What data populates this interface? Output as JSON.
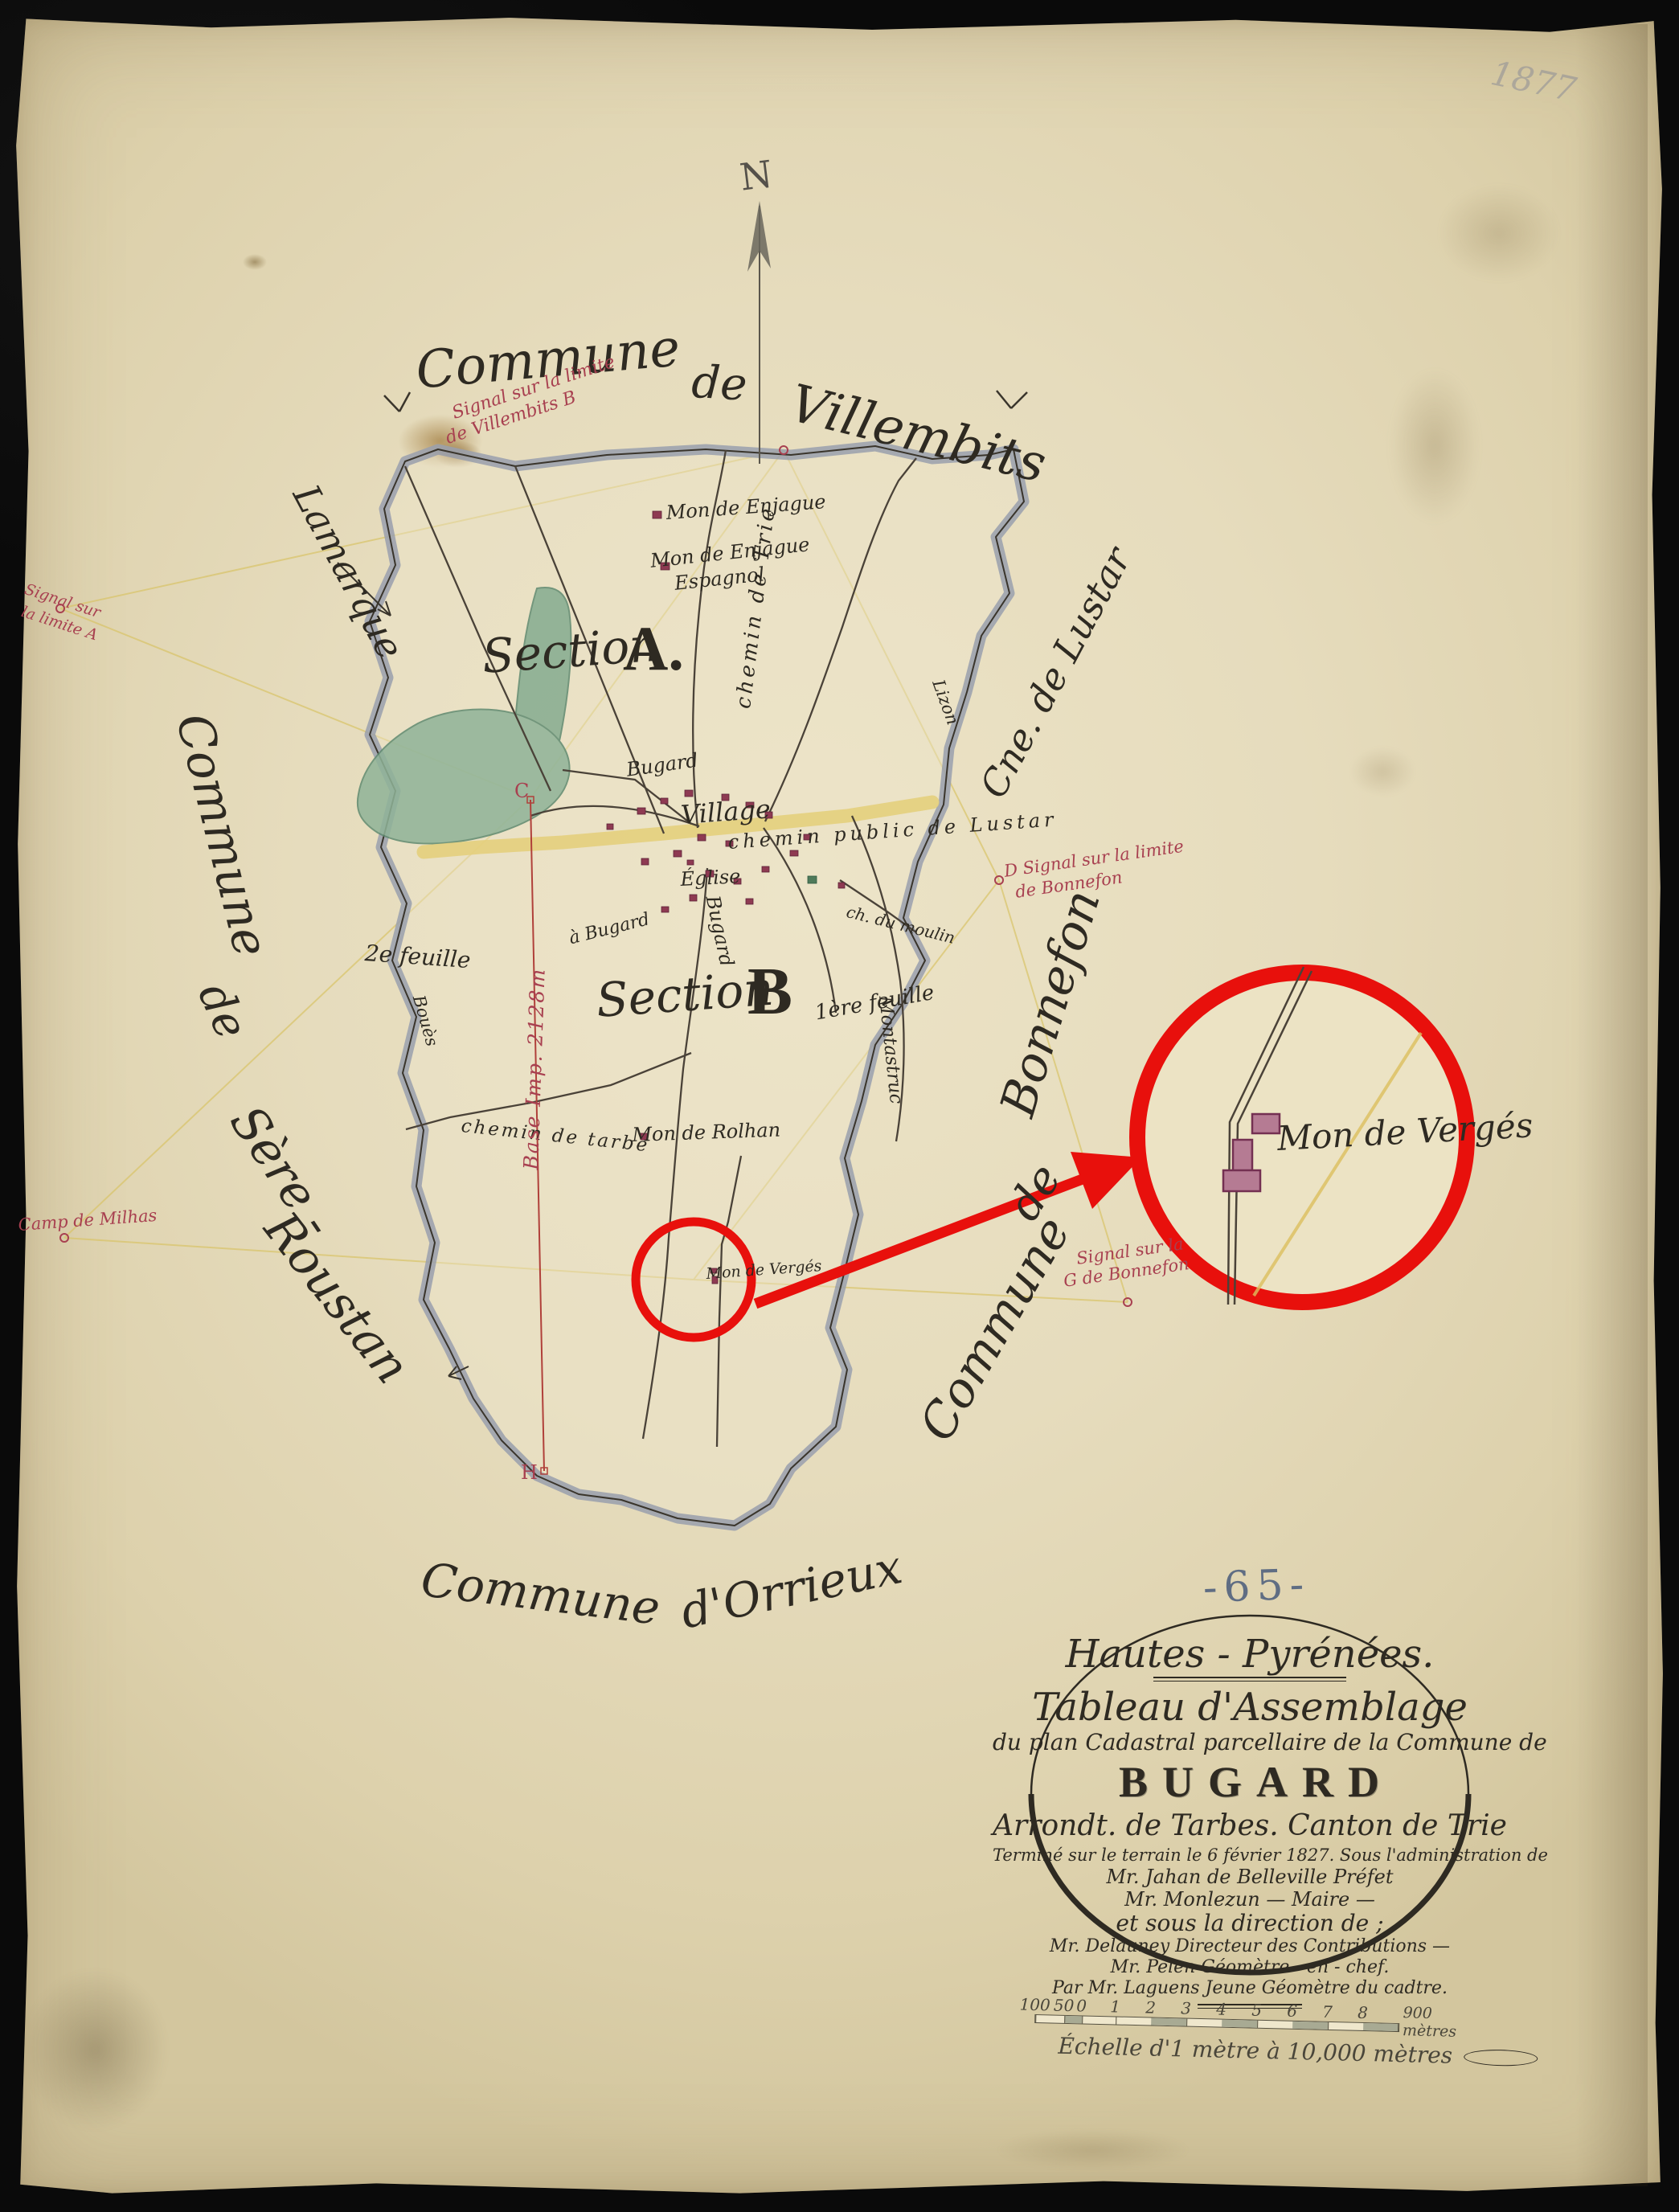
{
  "page": {
    "sheet_number": "-65-",
    "pencil_note": "1877",
    "north_label": "N"
  },
  "neighbors": {
    "top": {
      "w1": "Commune",
      "w2": "de",
      "w3": "Villembits"
    },
    "left_upper": "Lamarque",
    "left": {
      "w1": "Commune",
      "w2": "de",
      "w3": "Sère -",
      "w4": "Roustan"
    },
    "right_upper": "Cne. de Lustar",
    "right_lower": {
      "w1": "Commune",
      "w2": "de",
      "w3": "Bonnefon"
    },
    "bottom": {
      "w1": "Commune",
      "w2": "d'Orrieux"
    }
  },
  "sections": {
    "a_word": "Section",
    "a_letter": "A.",
    "b_word": "Section",
    "b_letter": "B",
    "b_note": "1ère feuille",
    "second_sheet": "2e feuille"
  },
  "village": {
    "name": "Village",
    "church": "Église"
  },
  "roads": {
    "bugard1": "Bugard",
    "bugard2": "Bugard",
    "bugard3": "à Bugard",
    "trie": "chemin de Trie",
    "lustar": "chemin public de Lustar",
    "tarbe": "chemin de tarbe",
    "moulin": "ch. du moulin",
    "montastruc": "Montastruc"
  },
  "streams": {
    "lizon": "Lizon",
    "boues": "Bouès"
  },
  "houses": {
    "enjague": "Mon de Enjague",
    "enjague_esp_1": "Mon de Enjague",
    "enjague_esp_2": "Espagnol",
    "rolhan": "Mon de Rolhan",
    "verges": "Mon de Vergés"
  },
  "inset": {
    "verges": "Mon de Vergés"
  },
  "annotations_red": {
    "signal_top_1": "Signal sur la limite",
    "signal_top_2": "de Villembits  B",
    "signal_d_1": "D Signal sur la limite",
    "signal_d_2": "de Bonnefon",
    "signal_g_1": "Signal sur la",
    "signal_g_2": "G de Bonnefon",
    "signal_left_1": "Signal sur",
    "signal_left_2": "la limite A",
    "camp": "Camp de Milhas",
    "base_line": "Base Imp. 2128m",
    "point_c": "C",
    "point_h": "H"
  },
  "cartouche": {
    "region": "Hautes - Pyrénées.",
    "title": "Tableau d'Assemblage",
    "subtitle": "du plan Cadastral parcellaire de la Commune de",
    "commune": "BUGARD",
    "admin": "Arrondt. de Tarbes.  Canton de Trie",
    "line1": "Terminé sur le terrain le 6 février 1827.  Sous l'administration de",
    "line2": "Mr. Jahan de Belleville Préfet",
    "line3": "Mr. Monlezun — Maire —",
    "line4": "et sous la direction de ;",
    "line5": "Mr. Delauney Directeur des Contributions —",
    "line6": "Mr. Pelen Géomètre - en - chef.",
    "line7": "Par Mr. Laguens Jeune Géomètre du cadtre."
  },
  "scale": {
    "ticks": [
      "100",
      "50",
      "0",
      "1",
      "2",
      "3",
      "4",
      "5",
      "6",
      "7",
      "8"
    ],
    "end_label": "900 mètres",
    "caption": "Échelle d'1 mètre à 10,000 mètres"
  },
  "colors": {
    "annotation_red": "#e8100c",
    "ink": "#2e2a22",
    "boundary_gray": "#9aa0ae",
    "water_green": "#85ab90",
    "road_yellow": "#e4cf7c",
    "building_red": "#8e3a52",
    "note_red": "#a84050",
    "pencil_blue": "#5f6d83",
    "paper": "#e3d8b8"
  }
}
